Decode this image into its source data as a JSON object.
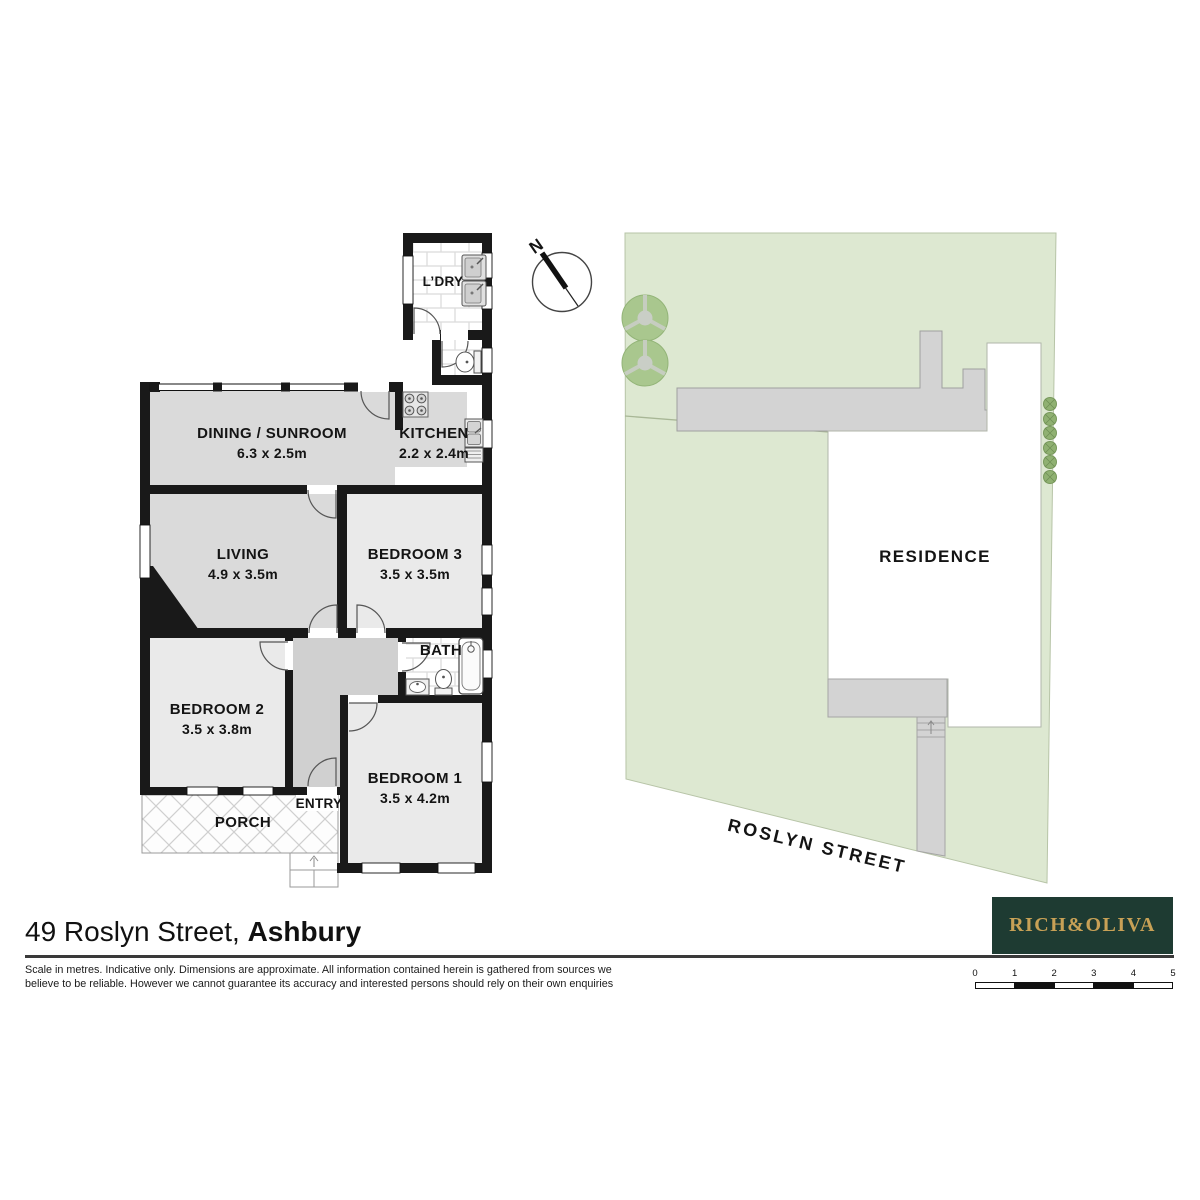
{
  "floor_plan": {
    "laundry": {
      "name": "L’DRY"
    },
    "dining": {
      "name": "DINING / SUNROOM",
      "dims": "6.3 x 2.5m"
    },
    "kitchen": {
      "name": "KITCHEN",
      "dims": "2.2 x 2.4m"
    },
    "living": {
      "name": "LIVING",
      "dims": "4.9 x 3.5m"
    },
    "bedroom3": {
      "name": "BEDROOM 3",
      "dims": "3.5 x 3.5m"
    },
    "bath": {
      "name": "BATH"
    },
    "bedroom2": {
      "name": "BEDROOM 2",
      "dims": "3.5 x 3.8m"
    },
    "bedroom1": {
      "name": "BEDROOM 1",
      "dims": "3.5 x 4.2m"
    },
    "entry": {
      "name": "ENTRY"
    },
    "porch": {
      "name": "PORCH"
    },
    "compass": {
      "north": "N"
    }
  },
  "site_plan": {
    "residence": "RESIDENCE",
    "street": "ROSLYN STREET"
  },
  "footer": {
    "address_regular": "49 Roslyn Street, ",
    "address_suburb": "Ashbury",
    "disclaimer_line1": "Scale in metres. Indicative only. Dimensions are approximate. All information contained herein is gathered from sources we",
    "disclaimer_line2": "believe to be reliable. However we cannot guarantee its accuracy and interested persons should rely on their own enquiries",
    "brand": "RICH&OLIVA",
    "scale": {
      "t0": "0",
      "t1": "1",
      "t2": "2",
      "t3": "3",
      "t4": "4",
      "t5": "5"
    }
  },
  "colors": {
    "wall_black": "#191919",
    "floor_grey": "#dadada",
    "hall_grey": "#d0d0d0",
    "bedroom_grey": "#eaeaea",
    "lot_green": "#dde8d1",
    "tree_green": "#a9c78e",
    "structure_grey": "#d3d3d3",
    "brand_green": "#1e3b32",
    "brand_gold": "#c8a156"
  }
}
